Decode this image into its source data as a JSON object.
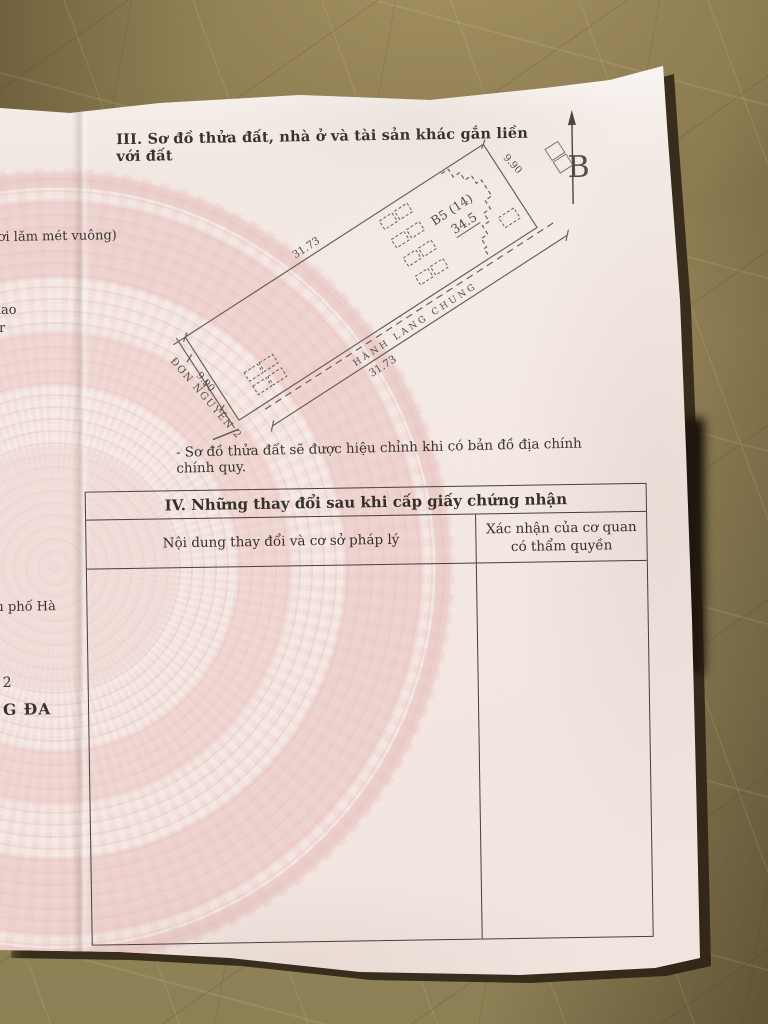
{
  "section3": {
    "title": "III. Sơ đồ thửa đất, nhà ở và tài sản khác gắn liền với đất",
    "note": "- Sơ đồ thửa đất sẽ được hiệu chỉnh khi có bản đồ địa chính chính quy."
  },
  "diagram": {
    "north_label": "B",
    "plot_label": "B5  (14)",
    "plot_area": "34.5",
    "dim_top": "31.73",
    "dim_bottom": "31.73",
    "dim_right": "9.90",
    "dim_left": "9.90",
    "corridor_label": "HÀNH LANG CHUNG",
    "block_label": "ĐƠN NGUYÊN 2"
  },
  "section4": {
    "title": "IV. Những thay đổi sau khi cấp giấy chứng nhận",
    "col1_header": "Nội dung thay đổi và cơ sở pháp lý",
    "col2_header_line1": "Xác nhận của cơ quan",
    "col2_header_line2": "có thẩm quyền"
  },
  "left_page_fragments": [
    "ơi lăm mét vuông)",
    "iao",
    "r",
    "u phố Hà",
    "2",
    "G ĐA"
  ]
}
